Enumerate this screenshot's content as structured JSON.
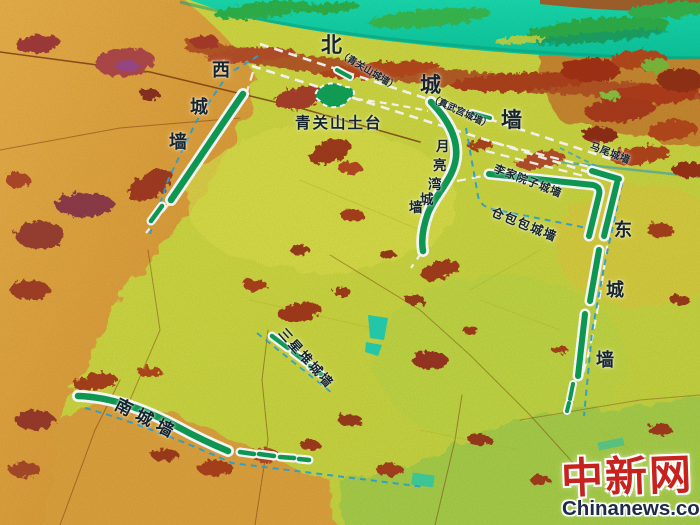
{
  "map": {
    "description": "LiDAR false-color terrain map of ancient city walls",
    "wall_labels": {
      "north_chars": [
        "北",
        "城",
        "墙"
      ],
      "west_chars": [
        "西",
        "城",
        "墙"
      ],
      "east_chars": [
        "东",
        "城",
        "墙"
      ],
      "south": "南城墙",
      "yueliangwan_chars": [
        "月",
        "亮",
        "湾",
        "城",
        "墙"
      ],
      "qingguanshan_section": "（青关山城墙）",
      "zhenwugong_section": "（真武宫城墙）",
      "lijiayuanzi_section": "李家院子城墙",
      "cangbaobao_section": "仓包包城墙",
      "mawei_section": "马尾城墙",
      "sanxingdui_section": "三星堆城墙"
    },
    "landmarks": {
      "qingguanshan_platform": "青关山土台"
    },
    "colors": {
      "preserved_wall_green": "#0f9e55",
      "inferred_wall_dash": "#ffffff",
      "survey_dash_blue": "#2da6d6",
      "river_teal": "#12cfa2",
      "terrain_yellow": "#ccd83e",
      "terrain_orange": "#e0a03c"
    }
  },
  "watermark": {
    "logo": "中新网",
    "site": "Chinanews.com",
    "logo_color": "#c6231f",
    "site_color": "#1d2b47"
  }
}
